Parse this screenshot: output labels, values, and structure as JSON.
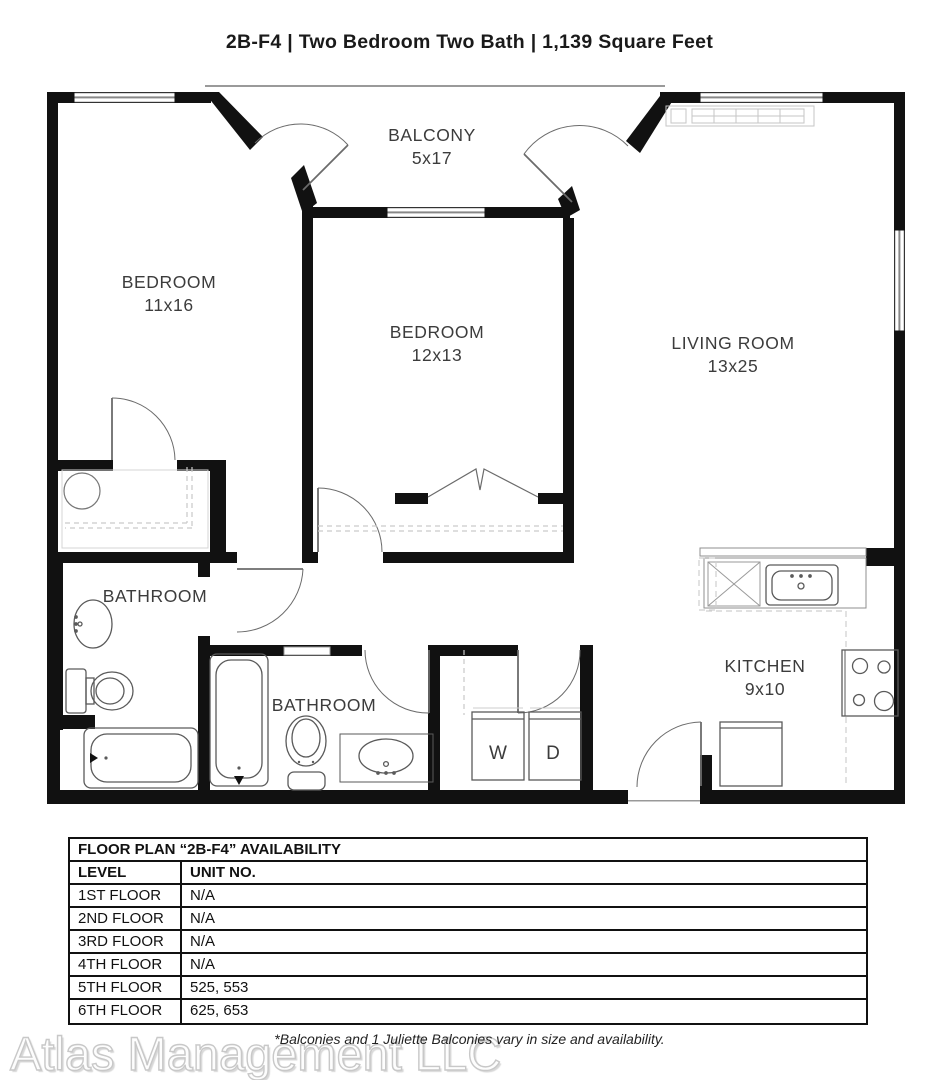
{
  "title": "2B-F4 | Two Bedroom Two Bath | 1,139 Square Feet",
  "plan": {
    "rooms": {
      "balcony": {
        "name": "BALCONY",
        "dims": "5x17"
      },
      "bedroom1": {
        "name": "BEDROOM",
        "dims": "11x16"
      },
      "bedroom2": {
        "name": "BEDROOM",
        "dims": "12x13"
      },
      "living_room": {
        "name": "LIVING ROOM",
        "dims": "13x25"
      },
      "bathroom1": {
        "name": "BATHROOM"
      },
      "bathroom2": {
        "name": "BATHROOM"
      },
      "kitchen": {
        "name": "KITCHEN",
        "dims": "9x10"
      }
    },
    "appliances": {
      "washer": "W",
      "dryer": "D"
    }
  },
  "availability_table": {
    "title": "FLOOR PLAN “2B-F4” AVAILABILITY",
    "columns": {
      "level": "LEVEL",
      "unit": "UNIT NO."
    },
    "rows": [
      {
        "level": "1ST FLOOR",
        "unit": "N/A"
      },
      {
        "level": "2ND FLOOR",
        "unit": "N/A"
      },
      {
        "level": "3RD FLOOR",
        "unit": "N/A"
      },
      {
        "level": "4TH FLOOR",
        "unit": "N/A"
      },
      {
        "level": "5TH FLOOR",
        "unit": "525, 553"
      },
      {
        "level": "6TH FLOOR",
        "unit": "625, 653"
      }
    ]
  },
  "footer": {
    "note": "*Balconies and 1 Juliette Balconies vary in size and availability.",
    "watermark": "Atlas Management LLC"
  },
  "colors": {
    "wall": "#111111",
    "fixture_line": "#5a5a5a",
    "label": "#3c3c3c",
    "dash": "#c9c9c9"
  }
}
